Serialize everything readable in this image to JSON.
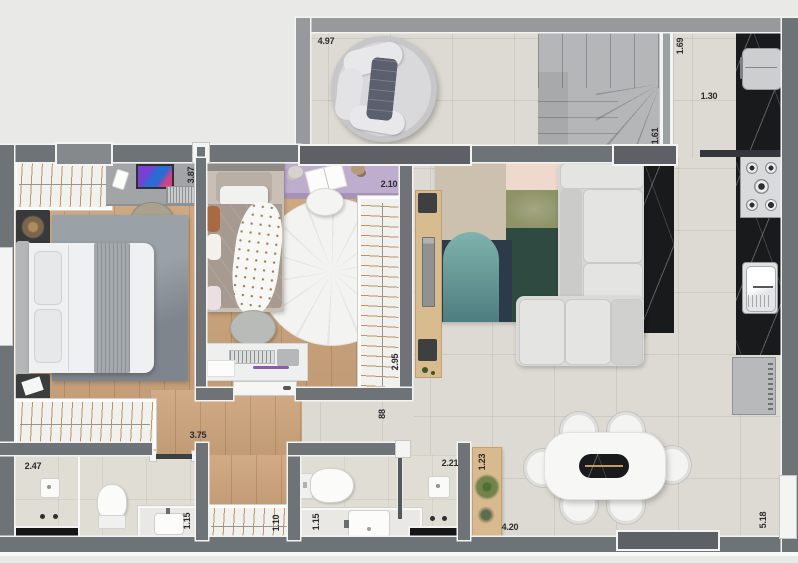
{
  "fp": {
    "image_type": "apartment-floor-plan-top-view-render",
    "labels": [
      {
        "text": "4.97",
        "room": "balcony",
        "orientation": "horizontal"
      },
      {
        "text": "1.69",
        "room": "stair-hall",
        "orientation": "vertical"
      },
      {
        "text": "1.30",
        "room": "kitchen-corridor",
        "orientation": "horizontal"
      },
      {
        "text": "1.61",
        "room": "stair-hall",
        "orientation": "vertical"
      },
      {
        "text": "3.87",
        "room": "bedroom-1",
        "orientation": "vertical"
      },
      {
        "text": "2.10",
        "room": "bedroom-2-desk",
        "orientation": "horizontal"
      },
      {
        "text": "2.95",
        "room": "bedroom-2-wardrobe",
        "orientation": "vertical"
      },
      {
        "text": "3.75",
        "room": "bedroom-1-wardrobe",
        "orientation": "horizontal"
      },
      {
        "text": "2.47",
        "room": "bathroom-1",
        "orientation": "horizontal"
      },
      {
        "text": "88",
        "room": "hallway",
        "orientation": "vertical"
      },
      {
        "text": "1.15",
        "room": "bathroom-1-vanity",
        "orientation": "vertical"
      },
      {
        "text": "1.10",
        "room": "linen-closet",
        "orientation": "vertical"
      },
      {
        "text": "1.15",
        "room": "bathroom-2-vanity",
        "orientation": "vertical"
      },
      {
        "text": "2.21",
        "room": "bathroom-2-shower",
        "orientation": "horizontal"
      },
      {
        "text": "1.23",
        "room": "entry-console",
        "orientation": "vertical"
      },
      {
        "text": "4.20",
        "room": "dining",
        "orientation": "horizontal"
      },
      {
        "text": "5.18",
        "room": "dining",
        "orientation": "vertical"
      }
    ],
    "colors": {
      "background": "#e9e9e8",
      "wall_dark": "#6e7377",
      "wall_light": "#97999c",
      "tile_floor": "#dcdad3",
      "wood_floor": "#cda57c",
      "bath_floor": "#e0ddd4",
      "marble_black": "#191a1c",
      "purple_desk": "#bfadce",
      "rug_beige": "#ccc1af",
      "rug_pink": "#eddacc",
      "rug_sage": "#8e9468",
      "rug_green": "#2f4a40",
      "rug_navy": "#2c3a49",
      "rug_teal": "#639a93",
      "label_text": "#2c2c2e"
    },
    "rooms": [
      {
        "name": "balcony",
        "furniture": [
          "round-daybed",
          "plant"
        ]
      },
      {
        "name": "stair-hall",
        "furniture": [
          "winder-staircase"
        ]
      },
      {
        "name": "kitchen",
        "furniture": [
          "refrigerator",
          "gas-cooktop",
          "kitchen-sink",
          "black-marble-counter",
          "black-marble-island",
          "washing-machine"
        ]
      },
      {
        "name": "living-room",
        "furniture": [
          "corner-sofa",
          "patchwork-rug",
          "tv-console",
          "tv"
        ]
      },
      {
        "name": "bedroom-1",
        "furniture": [
          "double-bed",
          "area-rug",
          "desk",
          "monitor",
          "laptop",
          "desk-chair",
          "closet",
          "wardrobe",
          "nightstand",
          "plant-table"
        ]
      },
      {
        "name": "bedroom-2",
        "furniture": [
          "single-bed",
          "round-rug",
          "study-desk",
          "desk-chair",
          "wardrobe",
          "wall-desk",
          "open-book"
        ]
      },
      {
        "name": "bathroom-1",
        "furniture": [
          "shower",
          "toilet",
          "vanity-sink",
          "linear-drain"
        ]
      },
      {
        "name": "bathroom-2",
        "furniture": [
          "toilet",
          "vanity-sink",
          "shower",
          "linear-drain",
          "glass-door"
        ]
      },
      {
        "name": "hallway",
        "furniture": [
          "linen-closet"
        ]
      },
      {
        "name": "dining",
        "furniture": [
          "dining-table",
          "dining-chair",
          "dining-chair",
          "dining-chair",
          "dining-chair",
          "dining-chair",
          "dining-chair",
          "wood-console",
          "plants"
        ]
      }
    ]
  }
}
